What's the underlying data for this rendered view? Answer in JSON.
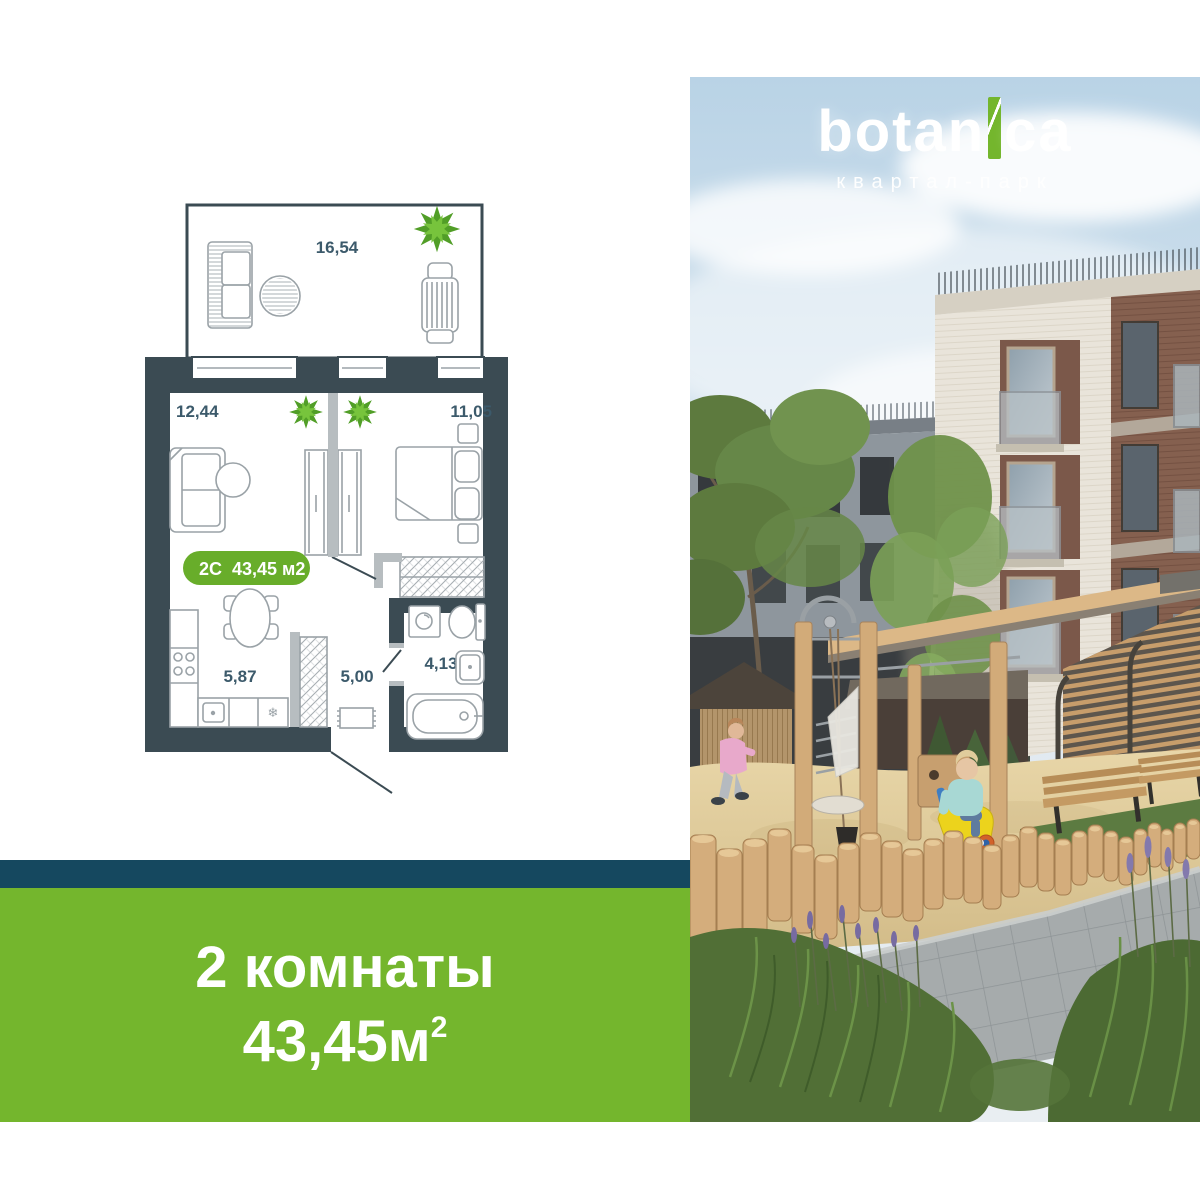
{
  "logo": {
    "brand_left": "botan",
    "brand_i": "i",
    "brand_right": "ca",
    "tagline": "квартал-парк"
  },
  "floorplan": {
    "badge": {
      "code": "2С",
      "area": "43,45 м2"
    },
    "rooms": {
      "terrace": "16,54",
      "living": "12,44",
      "bedroom": "11,05",
      "kitchen": "5,87",
      "hall": "5,00",
      "bathroom": "4,13"
    },
    "fridge_snowflake": "❄"
  },
  "banner": {
    "rooms_line": "2 комнаты",
    "area_value": "43,45",
    "area_unit": "м",
    "area_sup": "2"
  },
  "colors": {
    "navy": "#15485f",
    "green": "#74b62d",
    "badge": "#68ad2a",
    "wall": "#3b4b53",
    "line": "#9aa2a7",
    "label": "#3c5a6b",
    "plant_dark": "#519e27",
    "plant_light": "#77c43c",
    "jamb": "#b7bdc0"
  }
}
